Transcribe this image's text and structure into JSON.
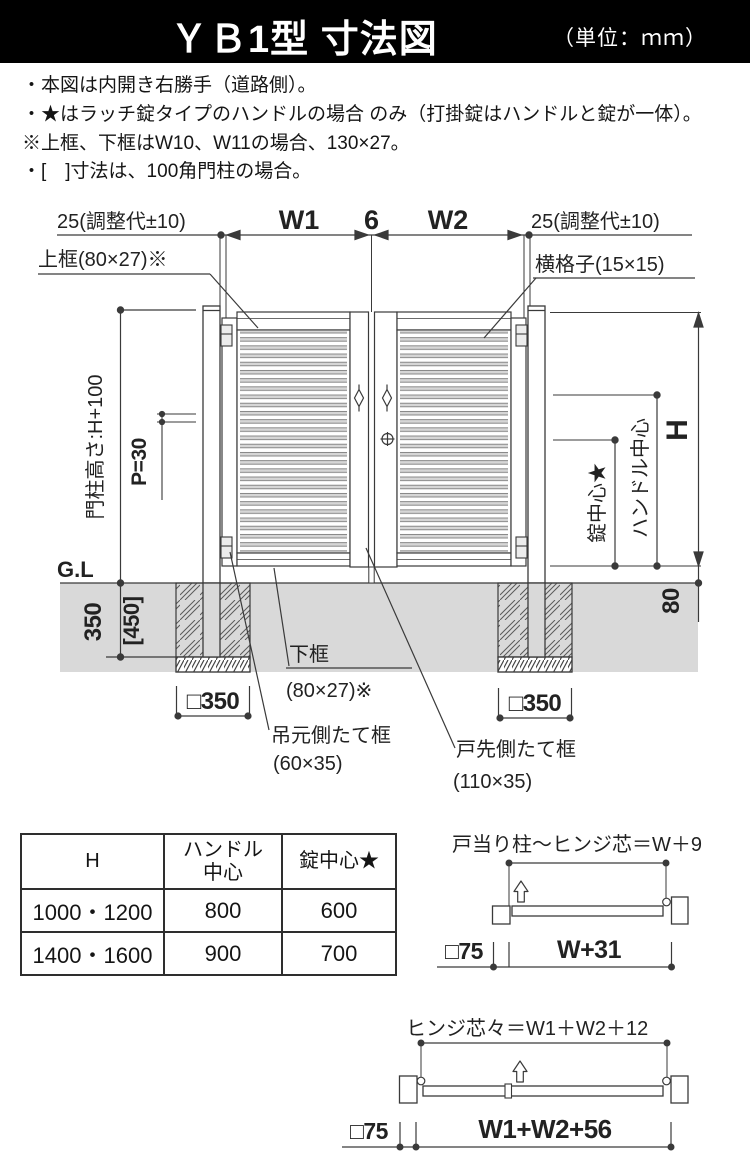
{
  "header": {
    "title": "ＹＢ1型 寸法図",
    "unit": "（単位：ｍｍ）"
  },
  "notes": [
    "・本図は内開き右勝手（道路側）。",
    "・★はラッチ錠タイプのハンドルの場合 のみ（打掛錠はハンドルと錠が一体）。",
    "※上框、下框はW10、W11の場合、130×27。",
    "・[　]寸法は、100角門柱の場合。"
  ],
  "diagram": {
    "dims": {
      "left_adjust": "25(調整代±10)",
      "w1": "W1",
      "gap6": "6",
      "w2": "W2",
      "right_adjust": "25(調整代±10)",
      "post_height": "門柱高さ:H+100",
      "pitch": "P=30",
      "gl": "G.L",
      "depth": "350",
      "depth_alt": "[450]",
      "found_left": "□350",
      "found_right": "□350",
      "height": "H",
      "handle_center": "ハンドル中心",
      "lock_center": "錠中心★",
      "bottom_gap": "80"
    },
    "labels": {
      "top_rail": "上框(80×27)※",
      "cross_bar": "横格子(15×15)",
      "bottom_rail": "下框",
      "bottom_rail_size": "(80×27)※",
      "hinge_stile": "吊元側たて框",
      "hinge_stile_size": "(60×35)",
      "latch_stile": "戸先側たて框",
      "latch_stile_size": "(110×35)"
    }
  },
  "table": {
    "col1_header": "H",
    "col2_header_line1": "ハンドル",
    "col2_header_line2": "中心",
    "col3_header": "錠中心★",
    "rows": [
      [
        "1000・1200",
        "800",
        "600"
      ],
      [
        "1400・1600",
        "900",
        "700"
      ]
    ]
  },
  "plan1": {
    "title": "戸当り柱～ヒンジ芯＝W＋9",
    "post": "□75",
    "width": "W+31"
  },
  "plan2": {
    "title": "ヒンジ芯々＝W1＋W2＋12",
    "post": "□75",
    "width": "W1+W2+56"
  }
}
